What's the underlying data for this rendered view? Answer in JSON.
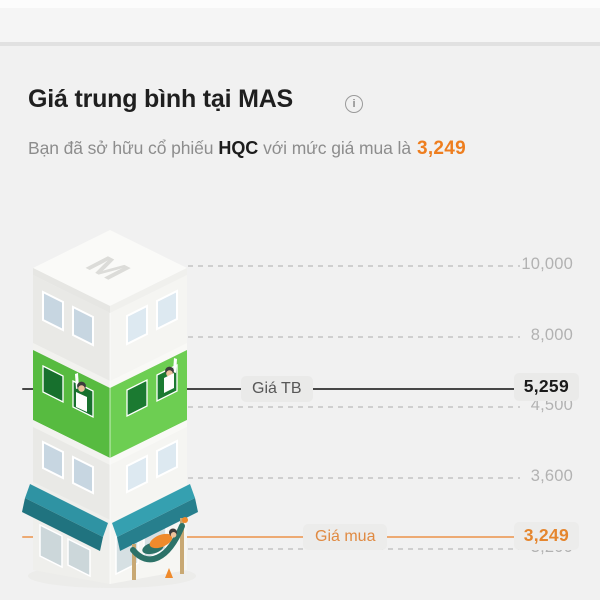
{
  "header": {
    "title": "Giá trung bình tại MAS",
    "subtitle_prefix": "Bạn đã sở hữu cổ phiếu",
    "ticker": "HQC",
    "subtitle_suffix": "với mức giá mua là",
    "purchase_price": "3,249"
  },
  "icons": {
    "info": "i"
  },
  "chart_data": {
    "type": "price-level-chart",
    "title": "Giá trung bình tại MAS",
    "grid": "dashed",
    "legend_position": "right",
    "y_ticks": [
      {
        "label": "10,000",
        "value": 10000
      },
      {
        "label": "8,000",
        "value": 8000
      },
      {
        "label": "4,500",
        "value": 4500
      },
      {
        "label": "3,600",
        "value": 3600
      },
      {
        "label": "3,200",
        "value": 3200
      }
    ],
    "markers": [
      {
        "name": "average-price",
        "label": "Giá TB",
        "display": "5,259",
        "value": 5259,
        "line_color": "#474747",
        "style": "solid"
      },
      {
        "name": "purchase-price",
        "label": "Giá mua",
        "display": "3,249",
        "value": 3249,
        "line_color": "#edaa73",
        "style": "solid"
      }
    ],
    "building": {
      "roof_letter": "M",
      "floors": 4,
      "highlighted_floor_color": "#57bb40"
    }
  },
  "colors": {
    "accent_orange": "#ee7e1f",
    "accent_green": "#57bb40",
    "awning_teal": "#2f93a3",
    "background": "#f1f1f1"
  }
}
